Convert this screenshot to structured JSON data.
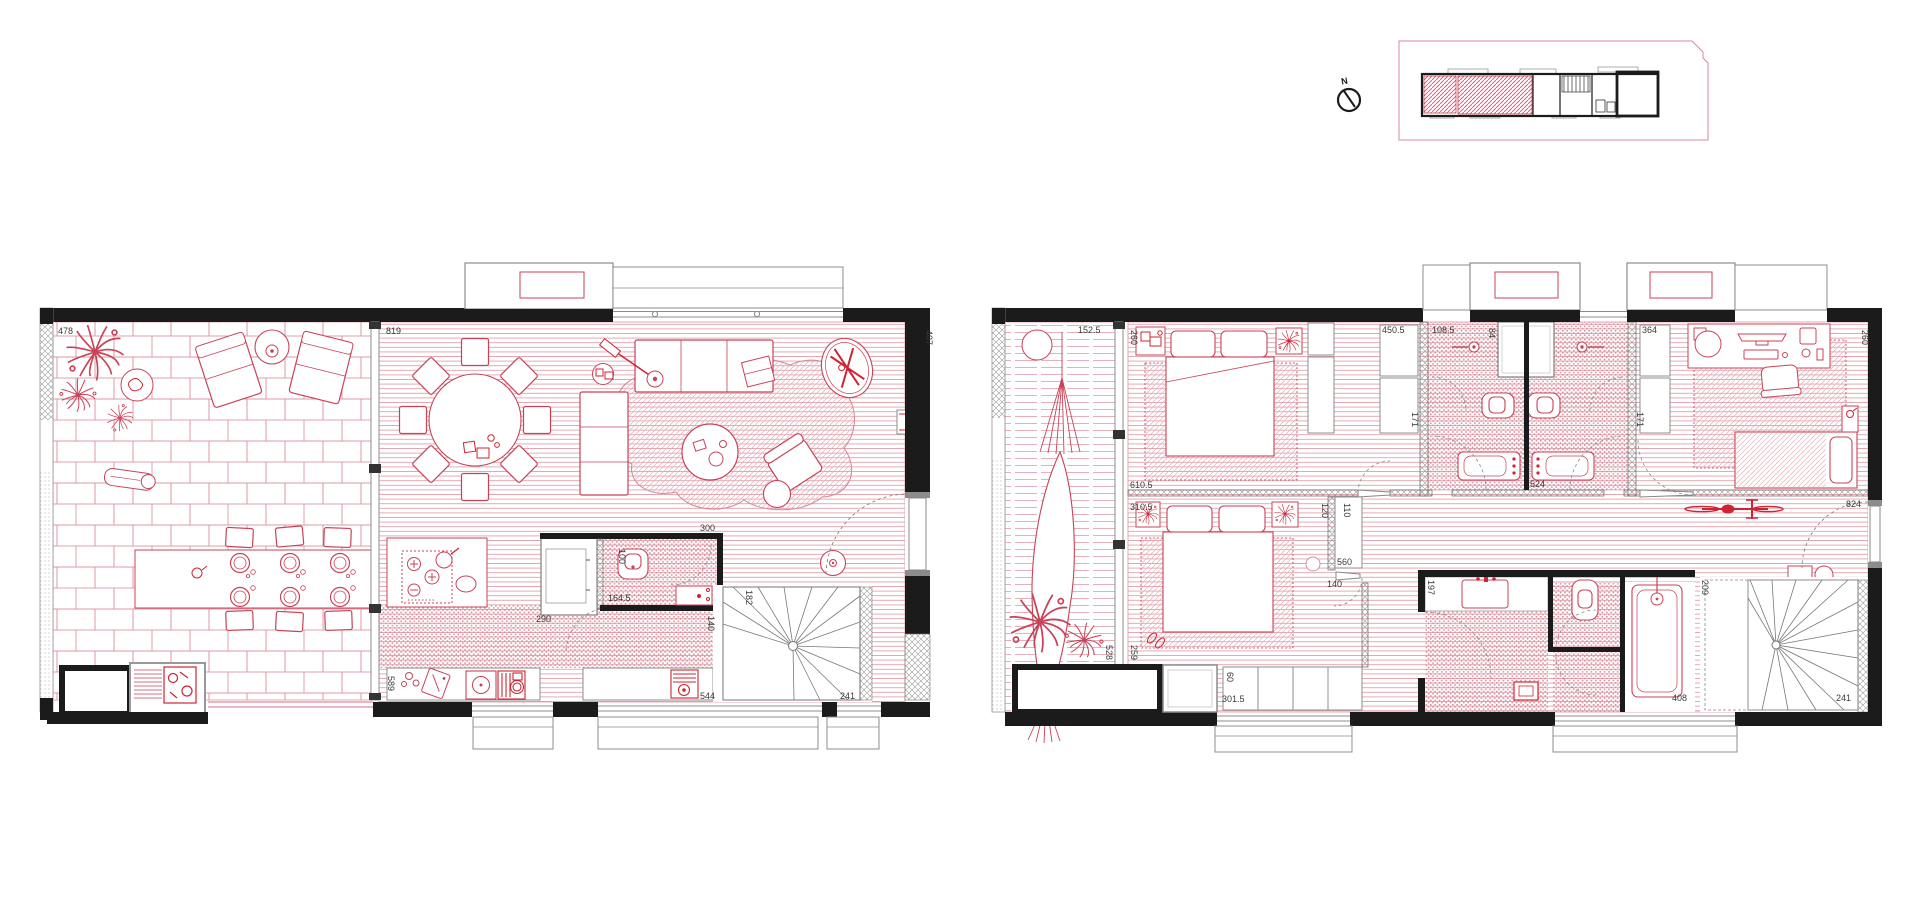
{
  "colors": {
    "accent": "#c94257",
    "accent_bright": "#cf2332",
    "hatch": "#dc96a2",
    "wall": "#1b1b1b",
    "frame": "#8c8c8c"
  },
  "north": {
    "label": "N"
  },
  "lower_floor": {
    "name": "lower-floor-plan",
    "dims": {
      "d478": "478",
      "d819": "819",
      "d407": "407",
      "d300": "300",
      "d100": "100",
      "d164_5": "164.5",
      "d290": "290",
      "d140": "140",
      "d182": "182",
      "d589": "589",
      "d544": "544",
      "d241": "241"
    }
  },
  "upper_floor": {
    "name": "upper-floor-plan",
    "dims": {
      "d152_5": "152.5",
      "d260a": "260",
      "d450_5": "450.5",
      "d108_5": "108.5",
      "d84": "84",
      "d364": "364",
      "d260b": "260",
      "d171a": "171",
      "d171b": "171",
      "d610_5": "610.5",
      "d310_5": "310.5",
      "d120": "120",
      "d110": "110",
      "d560": "560",
      "d140": "140",
      "d524": "524",
      "d824": "824",
      "d528": "528",
      "d259": "259",
      "d60": "60",
      "d301_5": "301.5",
      "d197": "197",
      "d408": "408",
      "d209": "209",
      "d241": "241"
    }
  }
}
